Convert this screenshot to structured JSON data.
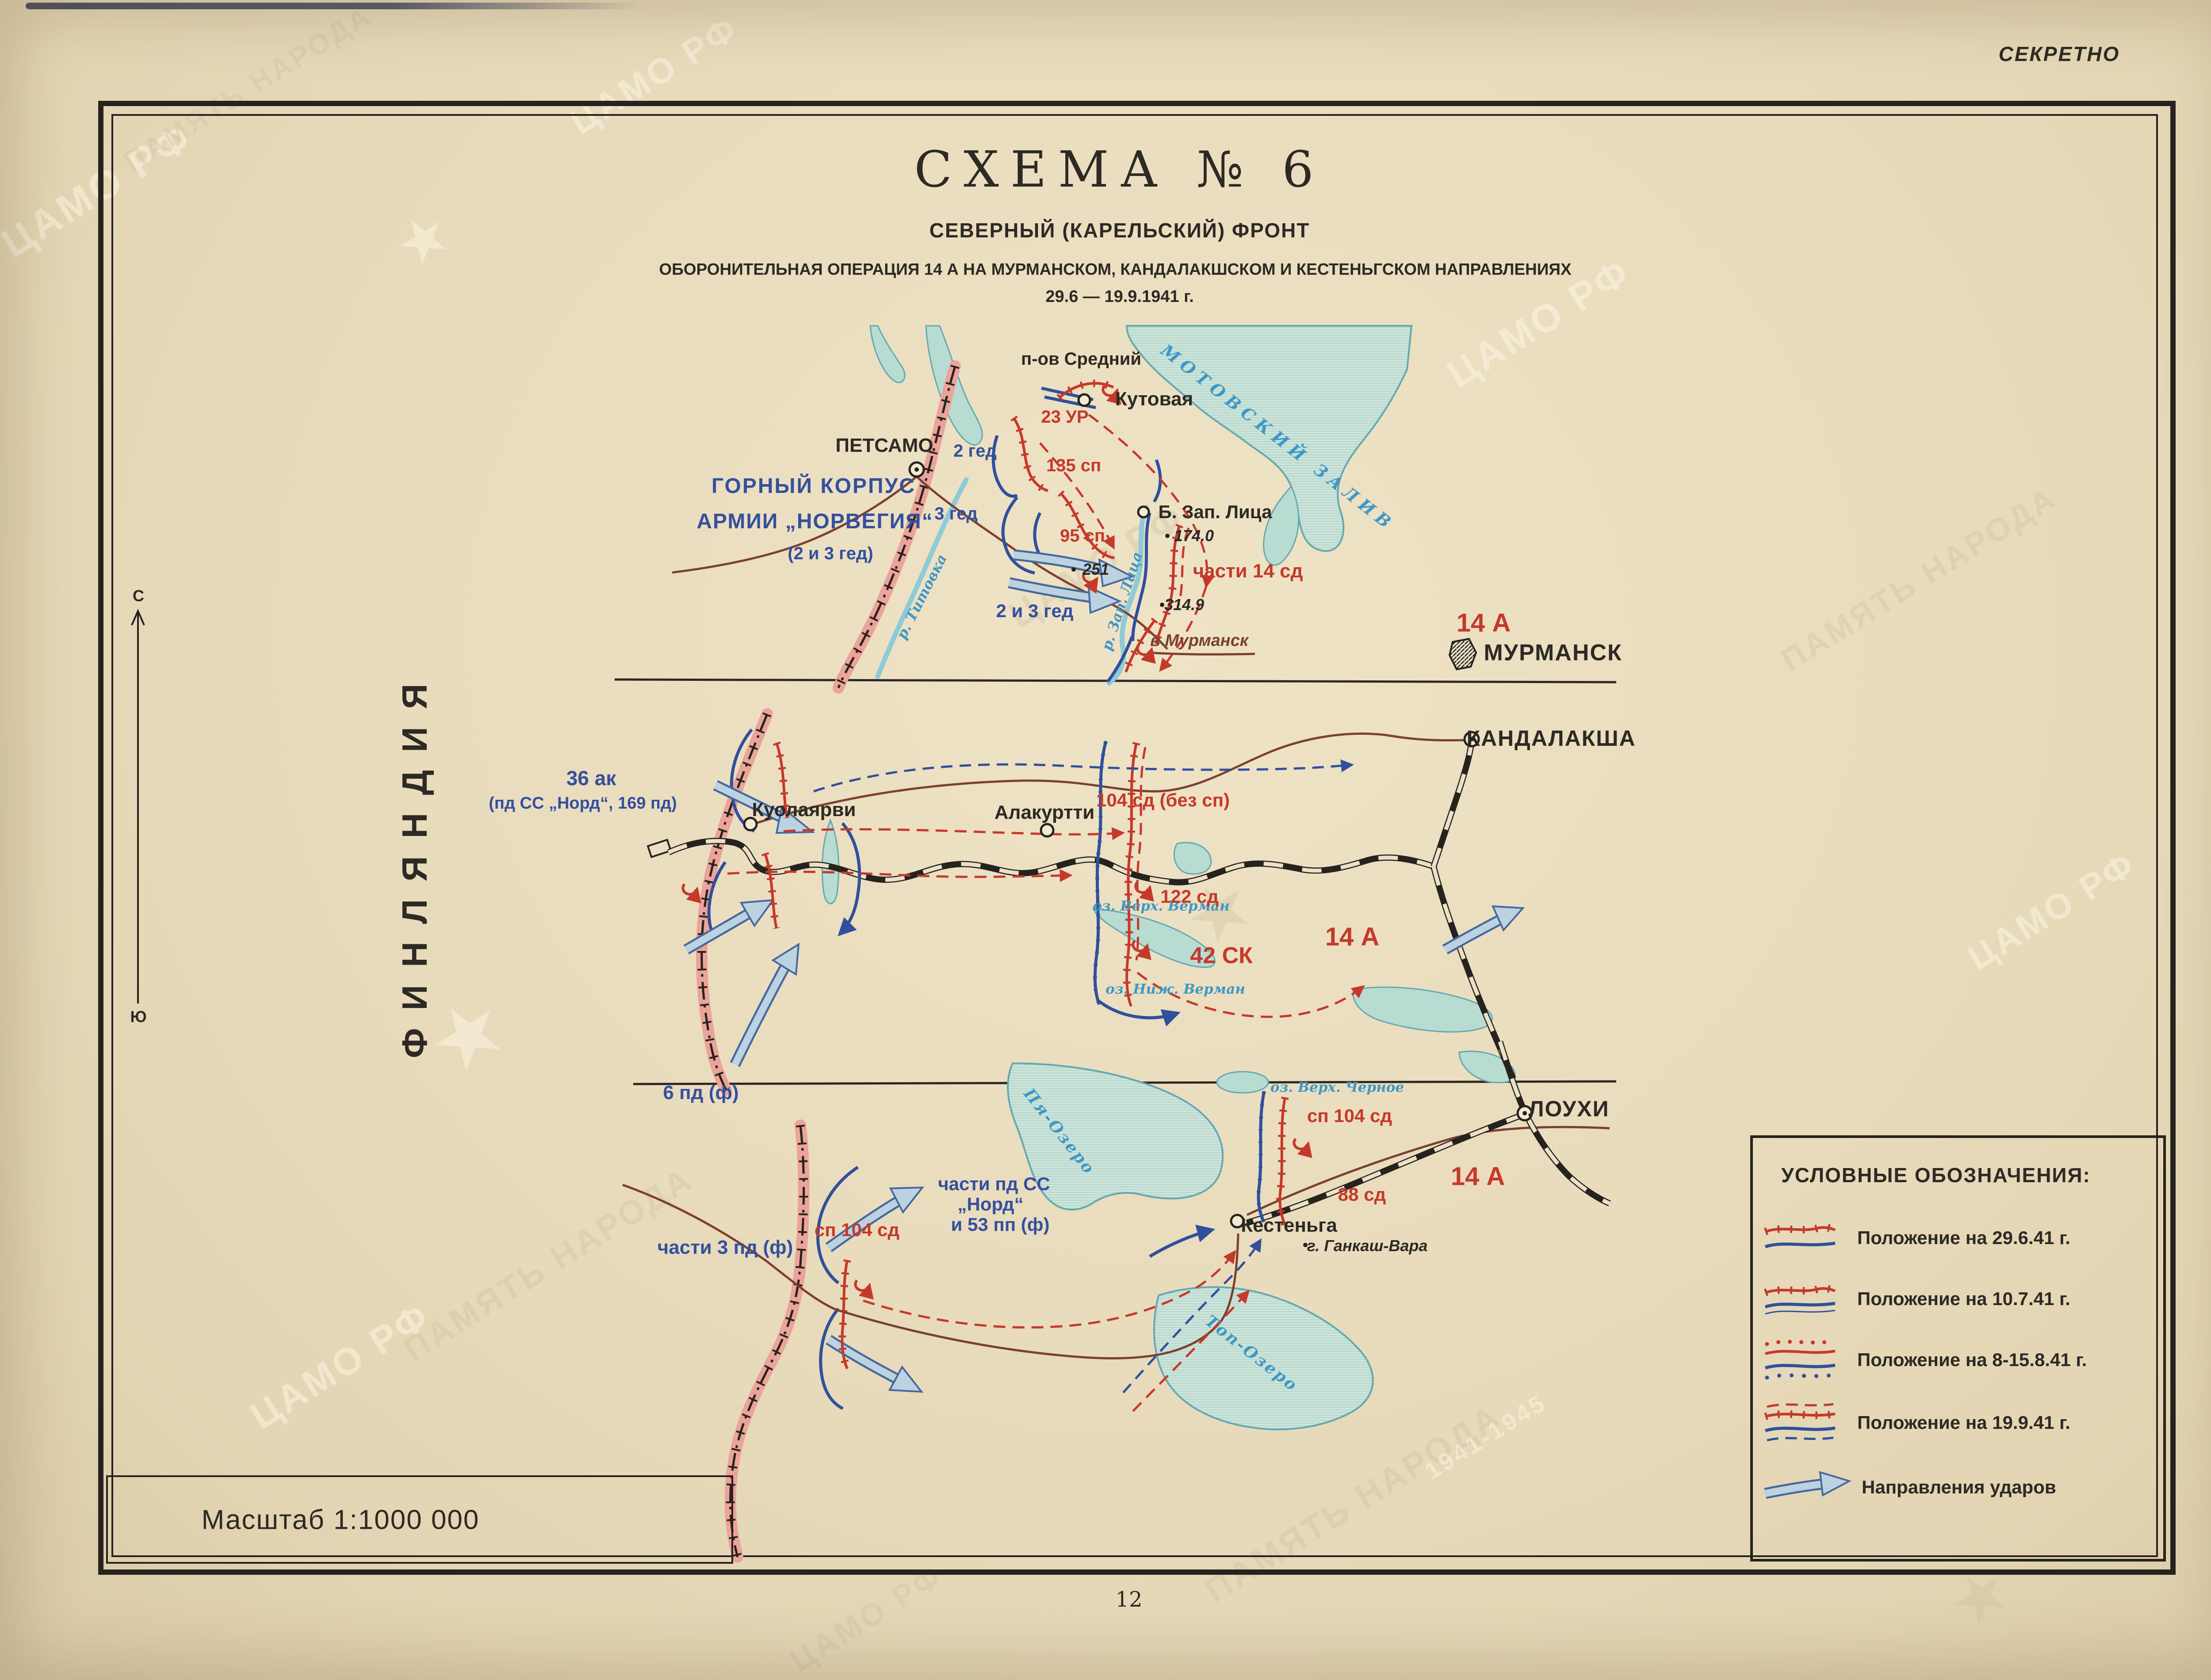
{
  "page": {
    "classification": "СЕКРЕТНО",
    "page_number": "12",
    "scale_label": "Масштаб 1:1000 000",
    "country_left": "ФИНЛЯНДИЯ",
    "compass": {
      "north": "С",
      "south": "Ю"
    },
    "watermarks": {
      "archive": "ЦАМО РФ",
      "memory": "ПАМЯТЬ НАРОДА",
      "years": "1941-1945",
      "star": "★"
    }
  },
  "title": {
    "scheme": "СХЕМА  № 6",
    "front": "СЕВЕРНЫЙ (КАРЕЛЬСКИЙ) ФРОНТ",
    "operation": "ОБОРОНИТЕЛЬНАЯ ОПЕРАЦИЯ 14 А НА МУРМАНСКОМ, КАНДАЛАКШСКОМ И КЕСТЕНЬГСКОМ НАПРАВЛЕНИЯХ",
    "dates": "29.6 — 19.9.1941 г."
  },
  "legend": {
    "title": "УСЛОВНЫЕ ОБОЗНАЧЕНИЯ:",
    "items": [
      {
        "label": "Положение на 29.6.41 г."
      },
      {
        "label": "Положение на 10.7.41 г."
      },
      {
        "label": "Положение на 8-15.8.41 г."
      },
      {
        "label": "Положение на 19.9.41 г."
      },
      {
        "label": "Направления ударов"
      }
    ]
  },
  "murmansk": {
    "peninsula": "п-ов Средний",
    "bay": "МОТОВСКИЙ ЗАЛИВ",
    "petsamo": "ПЕТСАМО",
    "kutovaya": "Кутовая",
    "b_zap_litsa": "Б. Зап. Лица",
    "murmansk_city": "МУРМАНСК",
    "corps1": "ГОРНЫЙ КОРПУС",
    "corps2": "АРМИИ „НОРВЕГИЯ“",
    "corps3": "(2 и 3 гед)",
    "u_2ged": "2 гед",
    "u_3ged": "3 гед",
    "u_23ur": "23 УР",
    "u_135sp": "135 сп",
    "u_95sp": "95 сп",
    "u_chasti14sd": "части 14 сд",
    "u_2i3ged": "2 и 3 гед",
    "army": "14 А",
    "h251": "251",
    "h174": "174.0",
    "h3149": "314.9",
    "r_titovka": "р. Титовка",
    "r_zap_litsa": "р. Зап. Лица",
    "to_murmansk": "в Мурманск"
  },
  "kandalaksha": {
    "ak36": "36 ак",
    "ak36sub": "(пд СС „Норд“, 169 пд)",
    "kuolajarvi": "Куолаярви",
    "alakurtti": "Алакуртти",
    "city": "КАНДАЛАКША",
    "u_104sd": "104 сд (без сп)",
    "u_42sk": "42 СК",
    "army": "14 А",
    "u_122sd": "122 сд",
    "u_6pd": "6 пд (ф)",
    "lake_verh": "оз. Верх. Верман",
    "lake_nizh": "оз. Ниж. Верман"
  },
  "kestenga": {
    "lake_pya": "Пя-Озеро",
    "lake_top": "Топ-Озеро",
    "lake_chernoe": "оз. Верх. Черное",
    "u_sp104_ne": "сп 104 сд",
    "u_sp104_w": "сп 104 сд",
    "u_88sd": "88 сд",
    "army": "14 А",
    "ss1": "части пд СС",
    "ss2": "„Норд“",
    "ss3": "и 53 пп (ф)",
    "u_3pd": "части 3 пд (ф)",
    "kestenga_town": "Кестеньга",
    "loukhi": "ЛОУХИ",
    "gankash": "г. Ганкаш-Вара"
  }
}
